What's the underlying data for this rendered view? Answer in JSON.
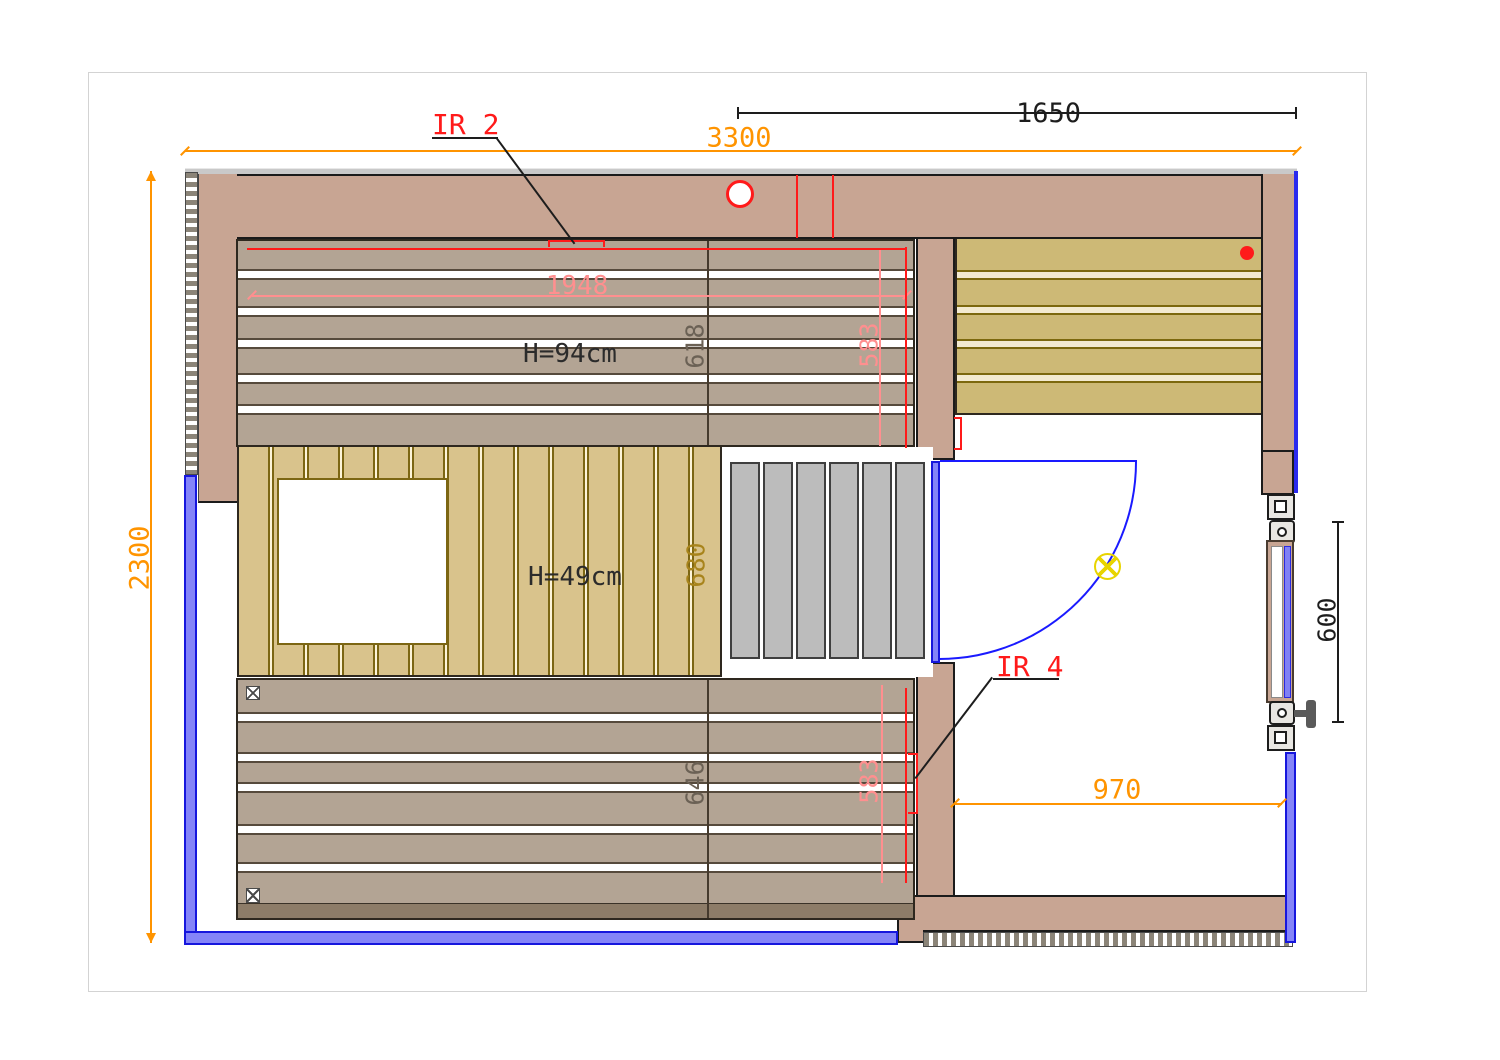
{
  "title": "Sauna floor plan CAD drawing",
  "dimensions": {
    "overall_width": "3300",
    "overall_depth": "2300",
    "right_section_width": "1650",
    "upper_bench_length": "1948",
    "upper_bench_depth": "618",
    "upper_ir_panel": "583",
    "mid_bench_depth": "680",
    "lower_bench_depth": "646",
    "lower_ir_panel": "583",
    "entry_width": "970",
    "window_height": "600"
  },
  "labels": {
    "ir_panel_2": "IR 2",
    "ir_panel_4": "IR 4",
    "upper_bench_height": "H=94cm",
    "mid_bench_height": "H=49cm"
  },
  "colors": {
    "wall_tan": "#c8a593",
    "bench_gray_brown": "#b3a494",
    "bench_wood_yellow": "#d9c38c",
    "room_slat_yellow": "#cdb976",
    "floor_slat_gray": "#bcbcbc",
    "glass_wall_blue": "#1616dd",
    "dimension_orange": "#ff9400",
    "annotation_red": "#ff1a1a",
    "dimension_pink": "#ff8f8f",
    "dimension_olive": "#6b6155",
    "dimension_mustard": "#a8841c",
    "dimension_black": "#1d1d1d",
    "light_symbol_yellow": "#e8d400"
  },
  "symbols": {
    "ceiling_light": "lamp-circle-x",
    "vent": "vent-circle",
    "sensor": "red-dot",
    "posts": "x-box"
  }
}
